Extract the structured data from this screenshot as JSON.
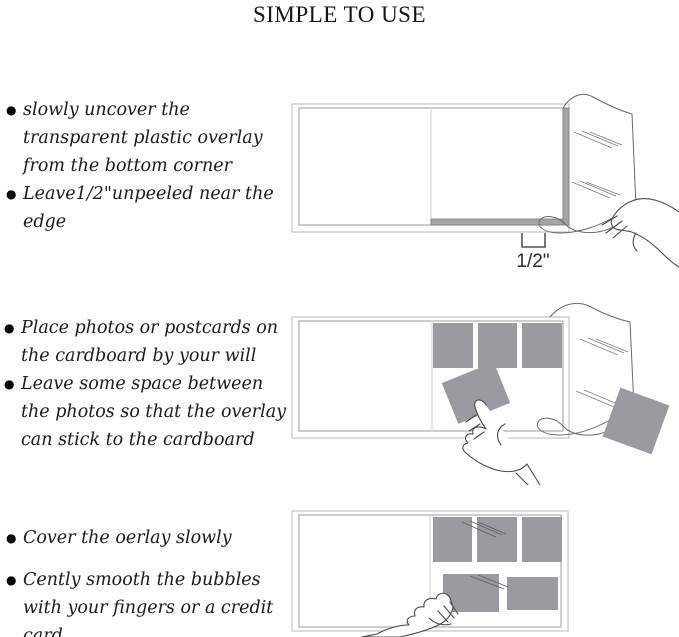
{
  "title": "SIMPLE TO USE",
  "steps": [
    {
      "bullets": [
        "slowly uncover the transparent plastic overlay from the bottom corner",
        "Leave1/2\"unpeeled near the edge"
      ]
    },
    {
      "bullets": [
        "Place photos or postcards on the cardboard by your will",
        "Leave some space between the photos so that the overlay can stick to the cardboard"
      ]
    },
    {
      "bullets": [
        "Cover the oerlay slowly",
        "Cently smooth the bubbles with your fingers or a credit card"
      ]
    }
  ],
  "figure1": {
    "measurement_label": "1/2\""
  },
  "bullet_glyph": "●",
  "colors": {
    "photo_gray": "#9a9aa0",
    "edge_strip_gray": "#a3a3a8",
    "album_outline": "#b8b8b8",
    "page_outline": "#9e9e9e",
    "sketch_line": "#4a4a4a",
    "text": "#1b1b1b"
  }
}
